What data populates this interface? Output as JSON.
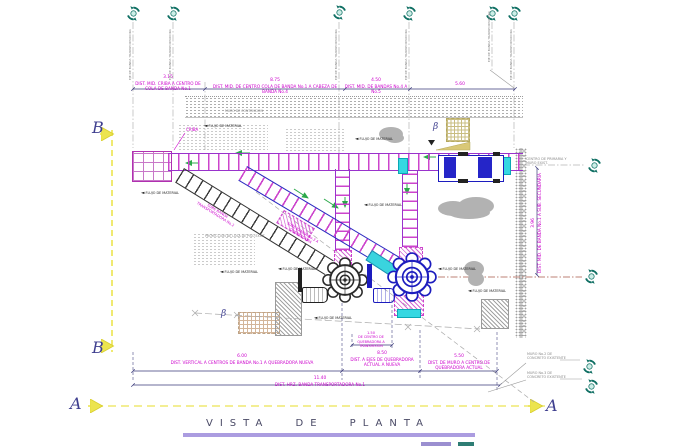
{
  "title": {
    "text": "VISTA DE PLANTA"
  },
  "sections": {
    "a": "A",
    "b": "B"
  },
  "dimensions": {
    "d315": {
      "value": "3.15",
      "label": "DIST. MID. CRIBA A CENTRO DE COLA DE BANDA No.1"
    },
    "d875": {
      "value": "8.75",
      "label": "DIST. MID. DE CENTRO COLA DE BANDA No.1 A CABEZA DE BANDA No.4"
    },
    "d450": {
      "value": "4.50",
      "label": "DIST. MID. DE BANDAS No.4 A No.5"
    },
    "d560": {
      "value": "5.60",
      "label": ""
    },
    "d396": {
      "value": "3.96",
      "label": "DIST. MID. DE BANDA No.1 A SUB. SECUNDARIA"
    },
    "d600": {
      "value": "6.00",
      "label": "DIST. VERTICAL A CENTROS DE BANDA No.1 A QUEBRADORA NUEVA"
    },
    "d850": {
      "value": "8.50",
      "label": "DIST. A EJES DE QUEBRADORA ACTUAL A NUEVA"
    },
    "d550": {
      "value": "5.50",
      "label": "DIST. DE MURO A CENTRO DE QUEBRADORA ACTUAL"
    },
    "d1140": {
      "value": "11.40",
      "label": "DIST. HRZ. BANDA TRANSPORTADORA No.1"
    },
    "d150": {
      "value": "1.50",
      "label": "DE CENTRO DE QUEBRADORA A TRANSMISION"
    }
  },
  "labels": {
    "criba": "CRIBA",
    "banda2": "SUBE BANDA TRANSPORTADORA No.2",
    "banda3": "SUBE BANDA No.3 A QUEBRADORA",
    "flow_arrow": "◄",
    "flow": "FLUJO DE MATERIAL",
    "muro_contencion": "MURO DE CONTENCION",
    "proyeccion": "PROYECCION DE LOSA DE PISO EXIST.",
    "centro_primaria": "CENTRO DE PRIMARIA Y MURO EXIST.",
    "muro2": "MURO No.2 DE CONCRETO EXISTENTE",
    "muro3": "MURO No.3 DE CONCRETO EXISTENTE",
    "eje": "EJE DE BANDA TRANSPORTADORA",
    "beta": "β"
  },
  "colors": {
    "magenta": "#cc00cc",
    "blue": "#1c1cbe",
    "cyan": "#35d8e2",
    "teal": "#0f6f63",
    "yellow": "#ece44e",
    "green": "#2ba84a",
    "navy": "#3a3a7a",
    "gray": "#9a9a9a",
    "title_bar": "#ab9ce0"
  }
}
